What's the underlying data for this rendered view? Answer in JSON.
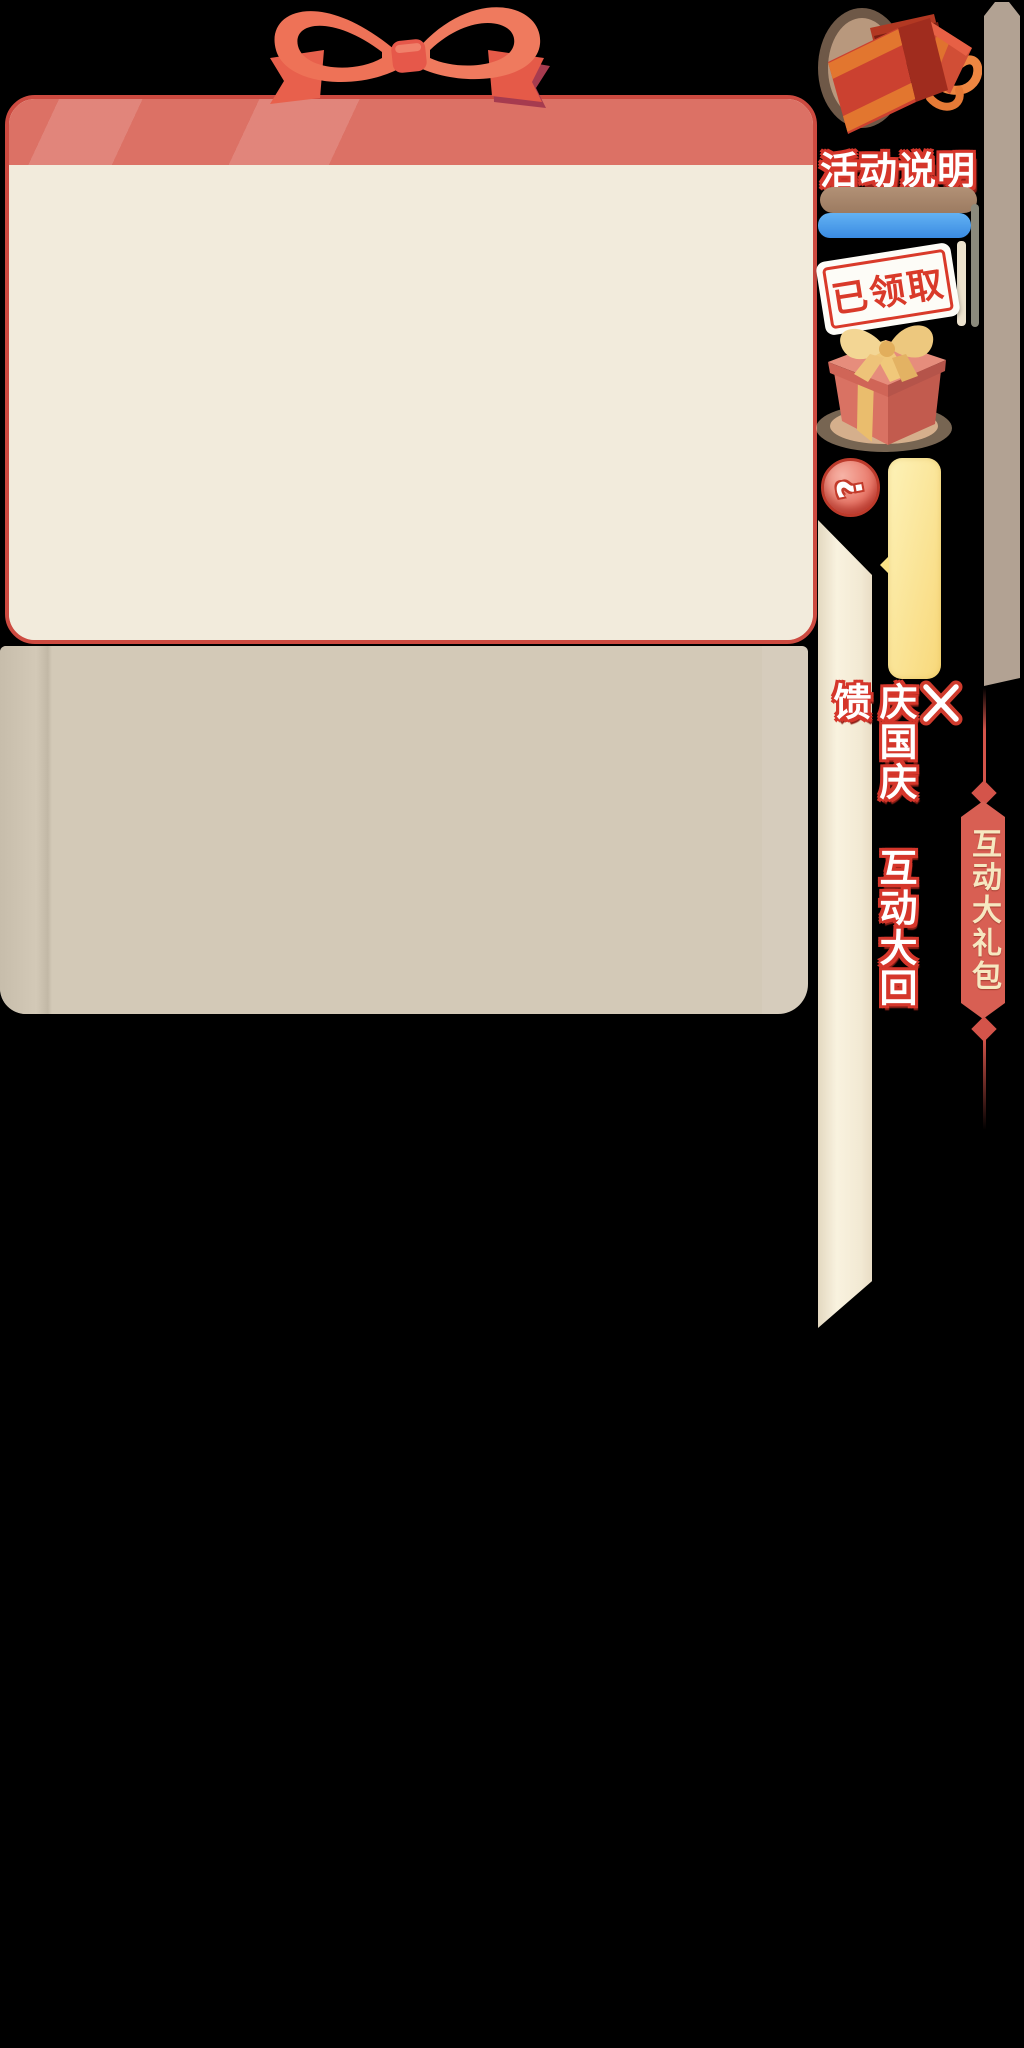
{
  "background": "#000000",
  "card": {
    "border_color": "#cd4a40",
    "header_color": "#dc7165",
    "body_color": "#f2ebdc",
    "panel_color": "#d3c9b7"
  },
  "rail": {
    "description_title": "活动说明",
    "claimed_stamp": "已领取",
    "help_glyph": "?",
    "close_glyph": "✕",
    "vertical_event_title": "庆国庆 互动大回馈",
    "banner_title": "互动大礼包",
    "banner_color": "#d85f53",
    "banner_text_color": "#f6e8c1",
    "brown_bar_color": "#a5846b",
    "blue_bar_color": "#3f90e4",
    "yellow_tab_color": "#f8d87a",
    "ribbon_color": "#f3ecd8",
    "right_bar_color": "#b2a293",
    "accent_red": "#d5362b"
  },
  "icons": {
    "bow": "gift-bow",
    "open_gift": "open-gift-box",
    "closed_gift": "closed-gift-box",
    "help": "question-mark",
    "close": "x-mark"
  }
}
